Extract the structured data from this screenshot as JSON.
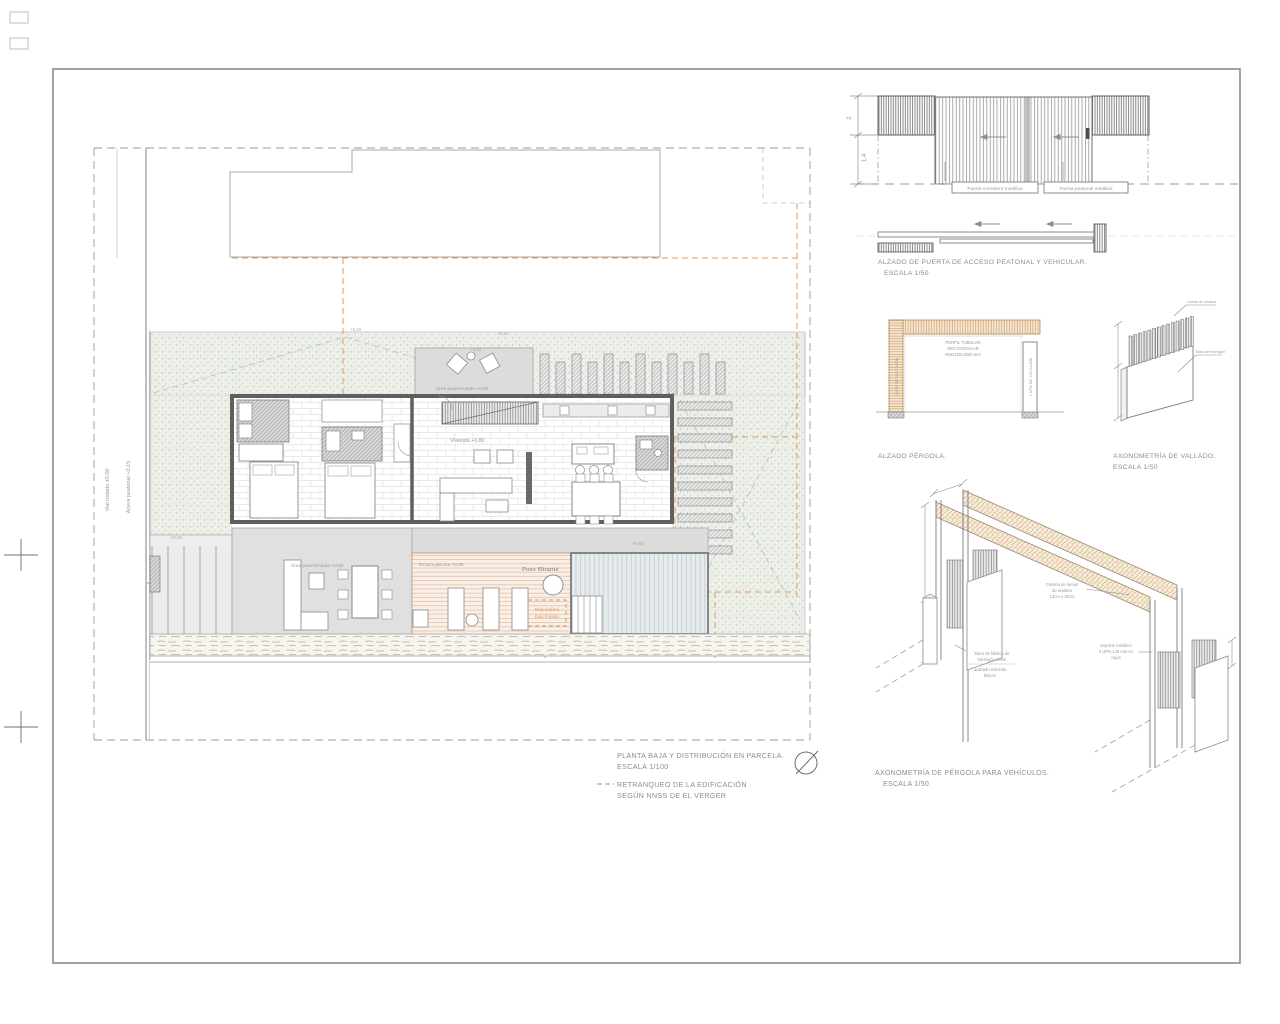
{
  "plan": {
    "title": "PLANTA BAJA Y DISTRIBUCIÓN  EN PARCELA.",
    "scale": "ESCALA 1/100",
    "legend_line1": "RETRANQUEO DE LA EDIFICACIÓN",
    "legend_line2": "SEGÚN NNSS DE EL VERGER",
    "labels": {
      "vial": "Vial rodado ±0,00",
      "acera": "Acera peatonal +0,15",
      "area_pavimentada_top": "Área pavimentada +0,80",
      "vivienda": "Vivienda +0,80",
      "area_pavimentada_bottom": "Área pavimentada +0,80",
      "terraza_piscina": "Terraza piscina +0,80",
      "pozo_filtrante": "Pozo filtrante",
      "depuradora_line1": "Depuradora",
      "depuradora_line2": "bajo forjado",
      "nivel_acceso": "+0,15",
      "nivel_top_left": "+0,15",
      "nivel_top_right": "+0,15",
      "nivel_patio": "+0,80",
      "nivel_piscina": "+0,80"
    }
  },
  "gate_elevation": {
    "dim_total": "2",
    "dim_partial": "1,4",
    "label_corredera": "Puerta corredera metálica",
    "label_peatonal": "Puerta peatonal metálica",
    "title": "ALZADO DE PUERTA DE ACCESO PEATONAL Y VEHICULAR.",
    "scale": "ESCALA 1/50"
  },
  "pergola_elevation": {
    "note_line1": "PERFIL TUBULAR",
    "note_line2": "RECTANGULAR",
    "note_line3": "600x120x3000 mm",
    "post_label_left": "2 UPN DE 120 CAJÓN",
    "post_label_right": "2 UPN DE 120 CAJÓN",
    "title": "ALZADO PÉRGOLA."
  },
  "vallado_axon": {
    "label_lamas": "Lamas de madera",
    "label_muro": "Muro de hormigón",
    "title": "AXONOMETRÍA DE VALLADO.",
    "scale": "ESCALA 1/50"
  },
  "pergola_axon": {
    "celosia_line1": "Celosía de lamas",
    "celosia_line2": "de madera",
    "celosia_line3": "12cm x 30cm",
    "muro_line1": "Muro de fábrica de",
    "muro_line2": "hormigón 20cm",
    "muro_line3": "acabado enlucido",
    "muro_line4": "blanco",
    "soporte_line1": "Soporte metálico",
    "soporte_line2": "2 UPN 140 mm en",
    "soporte_line3": "cajón",
    "title": "AXONOMETRÍA DE PÉRGOLA PARA VEHÍCULOS.",
    "scale": "ESCALA 1/50"
  },
  "colors": {
    "retranqueo_orange": "#E39A5B",
    "wood_tan": "#CD9F6B",
    "line_gray": "#7A7A7A"
  }
}
